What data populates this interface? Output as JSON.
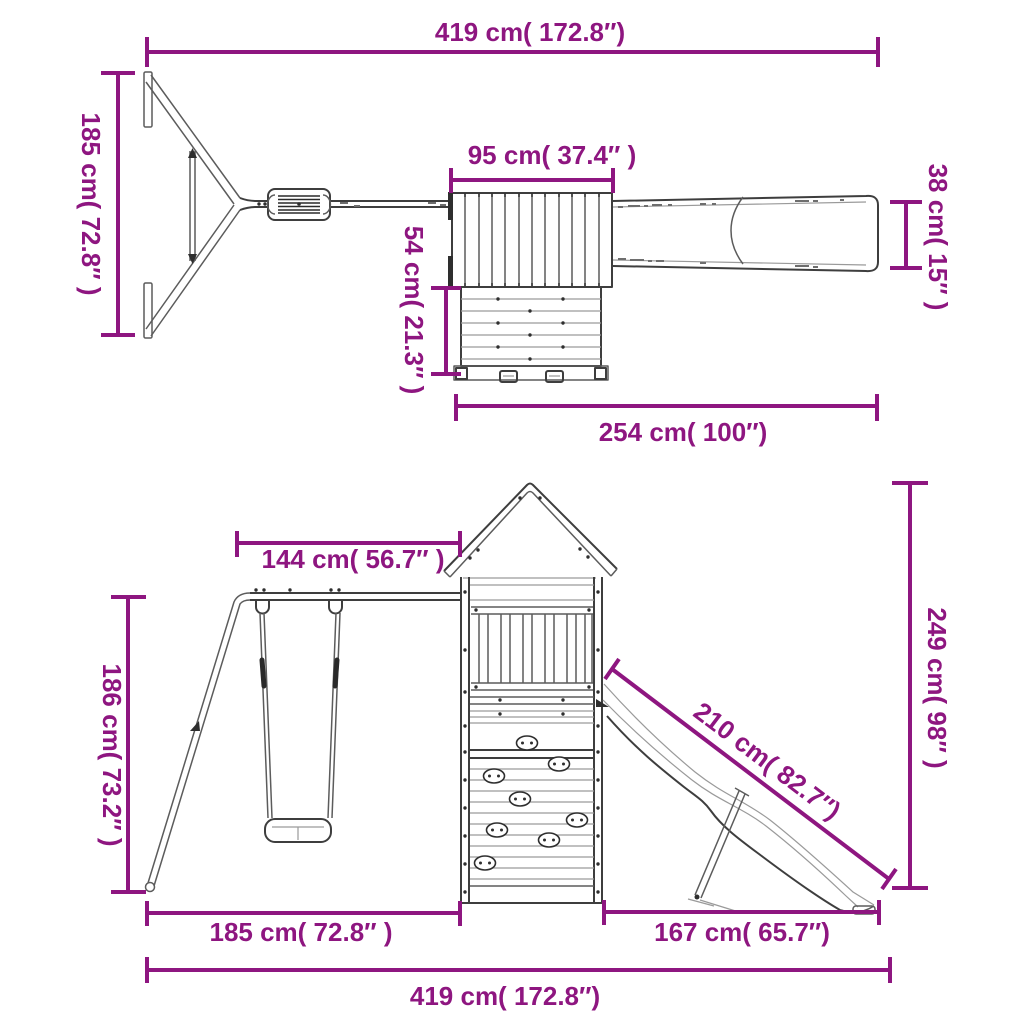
{
  "figure": {
    "subject": "Wooden playset with swing frame, play tower, climbing wall and slide — dimension drawing, top view and front view",
    "accent_color": "#8E1680",
    "artwork_color": "#3e3e3e",
    "views": {
      "top": {
        "dims": {
          "overall_width": "419 cm( 172.8″)",
          "swing_frame_depth": "185 cm( 72.8″ )",
          "roof_width": "95 cm( 37.4″ )",
          "climbing_wall_depth": "54 cm( 21.3″ )",
          "slide_width": "38 cm( 15″ )",
          "tower_slide_length": "254 cm( 100″)"
        }
      },
      "front": {
        "dims": {
          "beam_length": "144 cm( 56.7″ )",
          "swing_frame_height": "186 cm( 73.2″ )",
          "overall_height": "249 cm( 98″ )",
          "slide_length": "210 cm( 82.7″)",
          "swing_frame_width": "185 cm( 72.8″ )",
          "slide_footprint_width": "167 cm( 65.7″)",
          "overall_width": "419 cm( 172.8″)"
        }
      }
    }
  }
}
